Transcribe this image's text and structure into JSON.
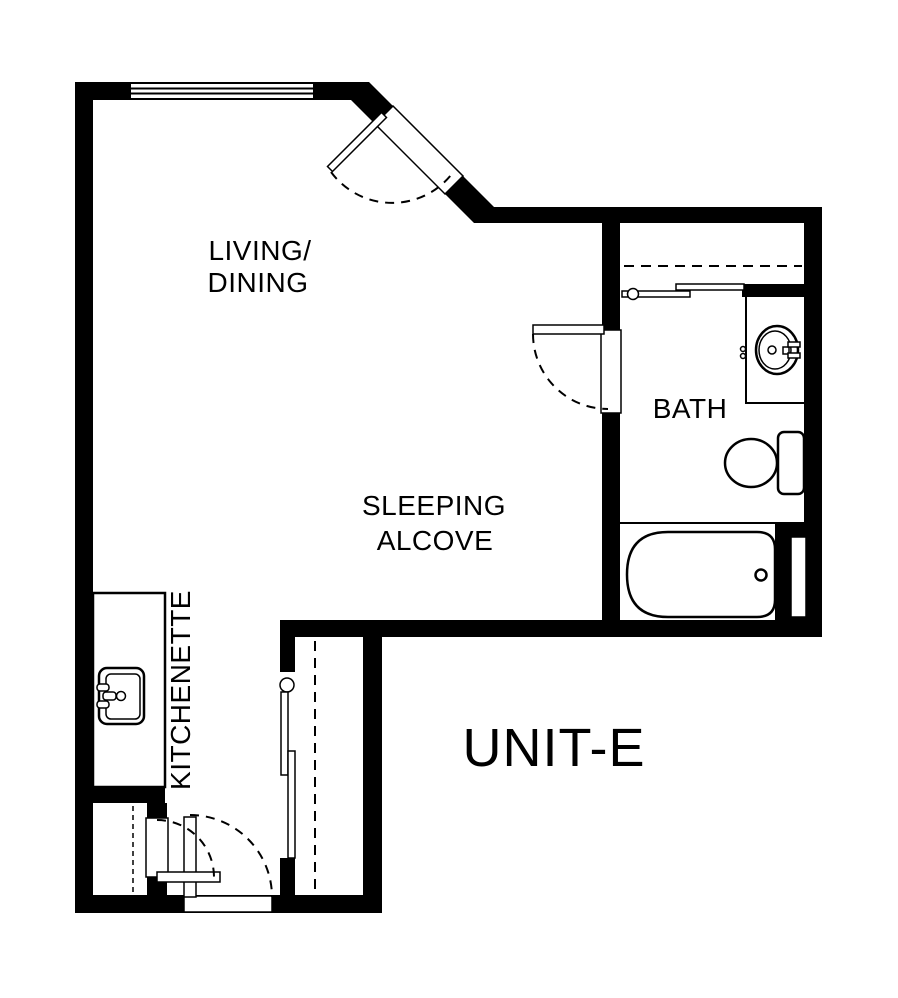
{
  "plan": {
    "unit_label": "UNIT-E",
    "rooms": {
      "living_dining": {
        "line1": "LIVING/",
        "line2": "DINING"
      },
      "sleeping_alcove": {
        "line1": "SLEEPING",
        "line2": "ALCOVE"
      },
      "bath": {
        "label": "BATH"
      },
      "kitchenette": {
        "label": "KITCHENETTE"
      }
    },
    "fixtures": [
      "window",
      "entry-door",
      "bath-door",
      "bath-closet-sliding-doors",
      "vanity-sink",
      "toilet",
      "bathtub",
      "wall-slot",
      "wardrobe-sliding-doors",
      "kitchen-sink",
      "utility-closet-door",
      "rear-door"
    ],
    "colors": {
      "wall": "#000000",
      "background": "#ffffff",
      "line": "#000000"
    }
  }
}
